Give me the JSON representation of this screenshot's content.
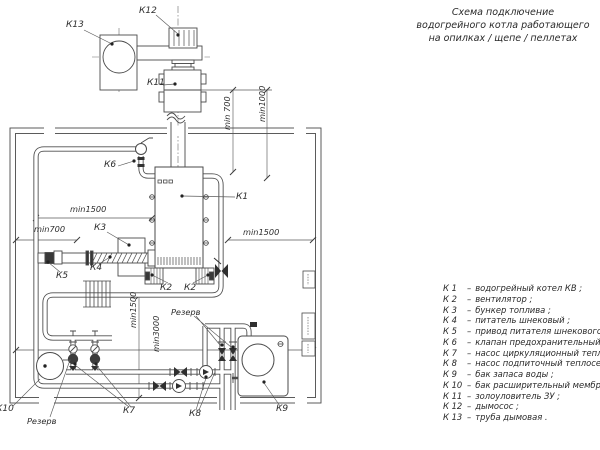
{
  "colors": {
    "line": "#4a4a4a",
    "text": "#2d2d2d",
    "fill_dark": "#383838",
    "background": "#ffffff"
  },
  "title": {
    "lines": [
      "Схема подключение",
      "водогрейного котла работающего",
      "на опилках / щепе / пеллетах"
    ]
  },
  "legend": {
    "items": [
      {
        "key": "К 1",
        "desc": "водогрейный котел КВ ;"
      },
      {
        "key": "К 2",
        "desc": "вентилятор ;"
      },
      {
        "key": "К 3",
        "desc": "бункер топлива ;"
      },
      {
        "key": "К 4",
        "desc": "питатель шнековый ;"
      },
      {
        "key": "К 5",
        "desc": "привод питателя шнекового ;"
      },
      {
        "key": "К 6",
        "desc": "клапан предохранительный ;"
      },
      {
        "key": "К 7",
        "desc": "насос циркуляционный теплосети ;"
      },
      {
        "key": "К 8",
        "desc": "насос подпиточный теплосети ;"
      },
      {
        "key": "К 9",
        "desc": "бак запаса воды ;"
      },
      {
        "key": "К 10",
        "desc": "бак расширительный мембранный ;"
      },
      {
        "key": "К 11",
        "desc": "золоуловитель ЗУ ;"
      },
      {
        "key": "К 12",
        "desc": "дымосос ;"
      },
      {
        "key": "К 13",
        "desc": "труба дымовая ."
      }
    ]
  },
  "labels": {
    "k1": "К1",
    "k2": "К2",
    "k3": "К3",
    "k4": "К4",
    "k5": "К5",
    "k6": "К6",
    "k7": "К7",
    "k8": "К8",
    "k9": "К9",
    "k10": "К10",
    "k11": "К11",
    "k12": "К12",
    "k13": "К13",
    "reserve": "Резерв"
  },
  "dimensions": {
    "min700_top": "min 700",
    "min1000": "min1000",
    "min1500_left": "min1500",
    "min700_left": "min700",
    "min1500_right": "min1500",
    "min1500_vertical": "min1500",
    "min3000": "min3000"
  }
}
